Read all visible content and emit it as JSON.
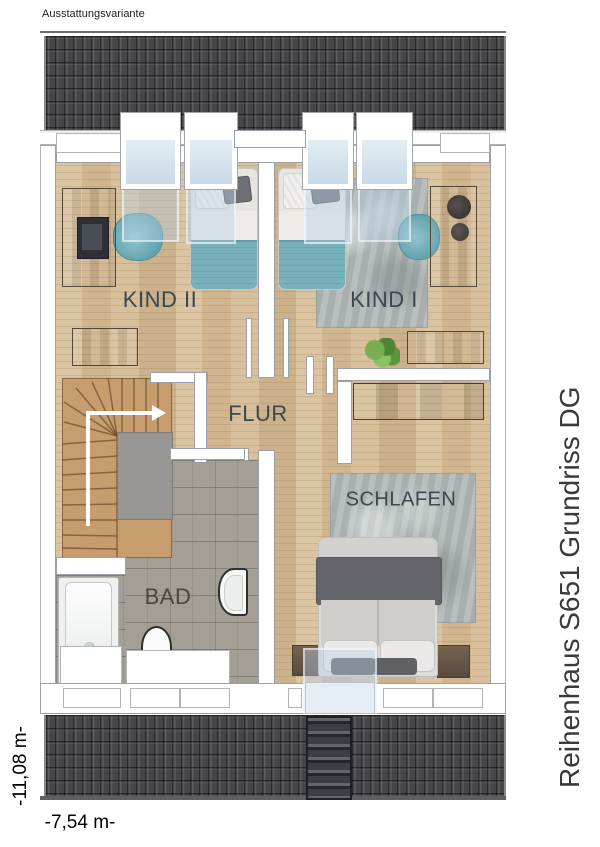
{
  "header": {
    "variant_label": "Ausstattungsvariante"
  },
  "rooms": {
    "kind2": {
      "label": "KIND II"
    },
    "kind1": {
      "label": "KIND I"
    },
    "flur": {
      "label": "FLUR"
    },
    "bad": {
      "label": "BAD"
    },
    "schlafen": {
      "label": "SCHLAFEN"
    }
  },
  "annotations": {
    "side_title": "Reihenhaus S651 Grundriss DG",
    "dimension_height": "-11,08 m-",
    "dimension_width": "-7,54 m-"
  },
  "colors": {
    "roof_tiles": "#45454a",
    "wood_floor": "#d6bd98",
    "stair_wood": "#c79d6e",
    "bath_tiles": "#a49f95",
    "accent_teal": "#78b0bc",
    "rug_gray": "#b1b9b8",
    "furniture_brown": "#7a675a",
    "skylight_glass": "#cfe0ec",
    "label_text": "#3e4650"
  }
}
